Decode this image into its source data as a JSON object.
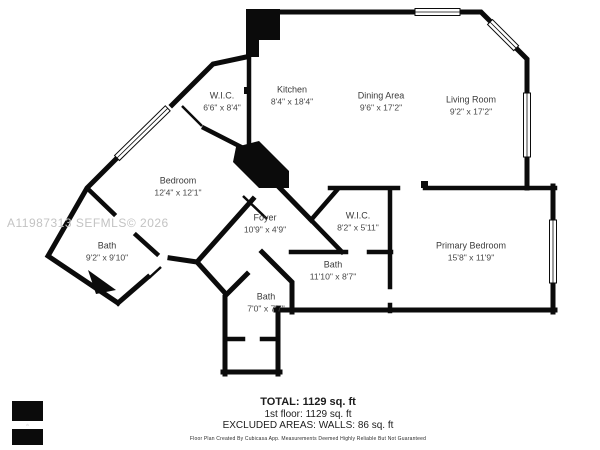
{
  "watermark": "A11987313  SEFMLS© 2026",
  "rooms": [
    {
      "name": "W.I.C.",
      "dims": "6'6\" x 8'4\""
    },
    {
      "name": "Kitchen",
      "dims": "8'4\" x 18'4\""
    },
    {
      "name": "Dining Area",
      "dims": "9'6\" x 17'2\""
    },
    {
      "name": "Living Room",
      "dims": "9'2\" x 17'2\""
    },
    {
      "name": "Bedroom",
      "dims": "12'4\" x 12'1\""
    },
    {
      "name": "Foyer",
      "dims": "10'9\" x 4'9\""
    },
    {
      "name": "W.I.C.",
      "dims": "8'2\" x 5'11\""
    },
    {
      "name": "Bath",
      "dims": "11'10\" x 8'7\""
    },
    {
      "name": "Primary Bedroom",
      "dims": "15'8\" x 11'9\""
    },
    {
      "name": "Bath",
      "dims": "9'2\" x 9'10\""
    },
    {
      "name": "Bath",
      "dims": "7'0\" x 7'7\""
    }
  ],
  "summary": {
    "total": "TOTAL: 1129 sq. ft",
    "floor": "1st floor: 1129 sq. ft",
    "excluded": "EXCLUDED AREAS: WALLS: 86 sq. ft",
    "disclaimer": "Floor Plan Created By Cubicasa App. Measurements Deemed Highly Reliable But Not Guaranteed"
  },
  "colors": {
    "wall": "#0b0b0b",
    "background": "#ffffff",
    "watermark": "#c3c3c3",
    "label_text": "#3b3b3b"
  }
}
